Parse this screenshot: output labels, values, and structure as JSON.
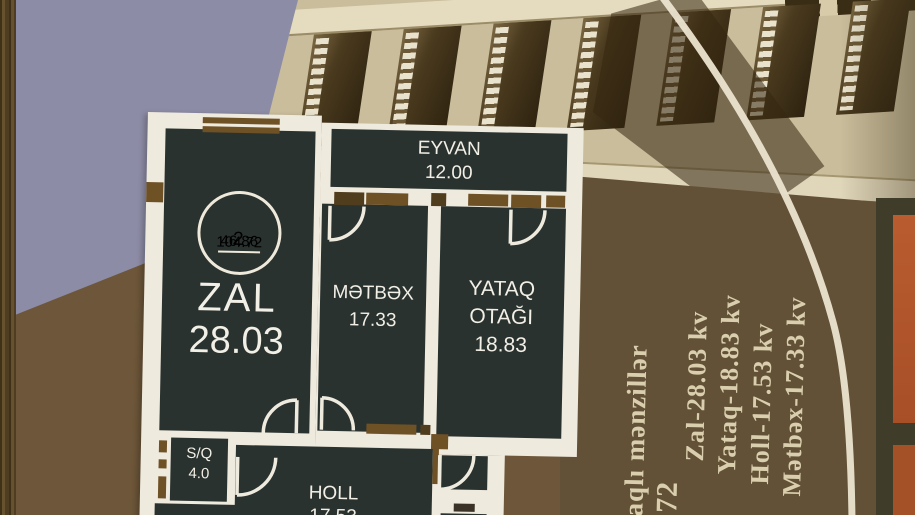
{
  "plan": {
    "badge": {
      "count": "2",
      "numerator": "46.86",
      "denominator": "104.72"
    },
    "rooms": {
      "zal": {
        "name": "ZAL",
        "area": "28.03"
      },
      "eyvan": {
        "name": "EYVAN",
        "area": "12.00"
      },
      "metbex": {
        "name": "MƏTBƏX",
        "area": "17.33"
      },
      "yataq": {
        "line1": "YATAQ",
        "line2": "OTAĞI",
        "area": "18.83"
      },
      "sq": {
        "name": "S/Q",
        "area": "4.0"
      },
      "holl": {
        "name": "HOLL",
        "area": "17.53"
      }
    }
  },
  "sidebar": {
    "title_partial": "taqlı mənzillər",
    "number_partial": ".72",
    "specs": [
      "Zal-28.03 kv",
      "Yataq-18.83 kv",
      "Holl-17.53 kv",
      "Mətbəx-17.33 kv"
    ]
  },
  "colors": {
    "sky": "#8d8ca6",
    "ground_left": "#6d5639",
    "ground_right": "#625136",
    "room_fill": "#2a322f",
    "sheet": "#efeade",
    "accent_brown": "#6f5126",
    "arc": "#ece4d0",
    "spec_text": "#d9cfae",
    "orange_panel": "#b25a2e"
  }
}
